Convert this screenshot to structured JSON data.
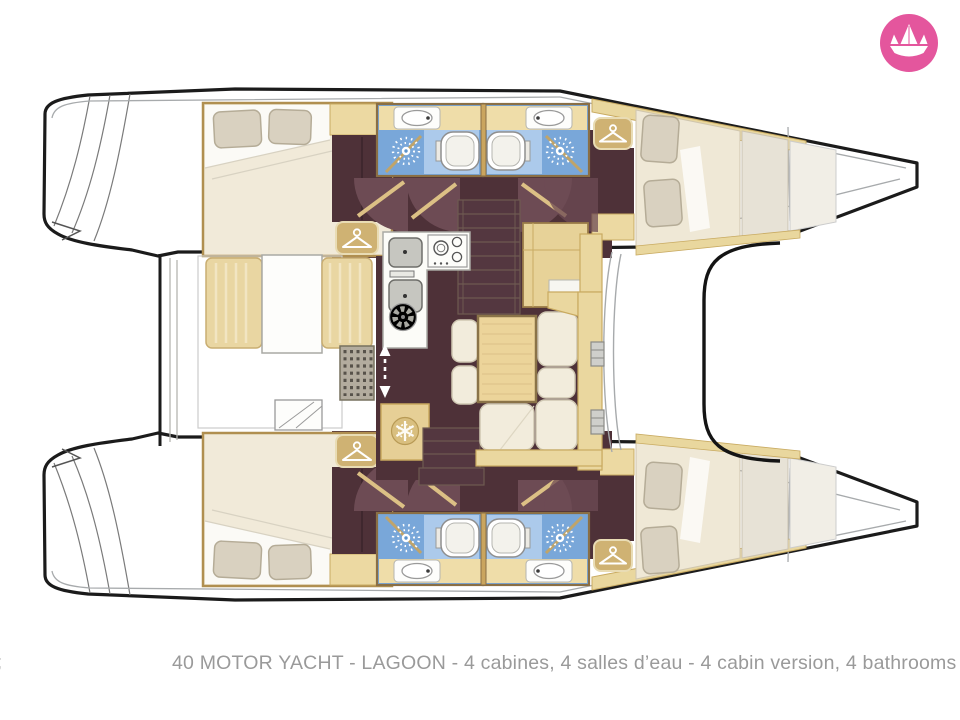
{
  "page": {
    "background_color": "#ffffff",
    "kind": "catamaran yacht deck floor plan"
  },
  "branding": {
    "logo_icon": "paper-boat-icon",
    "logo_bg_color": "#e4569d",
    "logo_fg_color": "#ffffff"
  },
  "caption": {
    "text": "40 MOTOR YACHT - LAGOON - 4 cabines, 4 salles d’eau - 4 cabin version, 4 bathrooms",
    "left_edge_fragment": ";",
    "text_color": "#9a9a9a"
  },
  "floorplan": {
    "vessel_type": "catamaran",
    "cabins_count": 4,
    "bathrooms_count": 4,
    "features": [
      "double-bed-cabin-port-aft",
      "double-bed-cabin-port-forward",
      "double-bed-cabin-starboard-aft",
      "double-bed-cabin-starboard-forward",
      "bathroom-port-aft",
      "bathroom-port-forward",
      "bathroom-starboard-aft",
      "bathroom-starboard-forward",
      "galley-with-sinks-and-stove",
      "salon-table-with-sofa",
      "cockpit-bench",
      "companionway-stairs-forward",
      "companionway-stairs-aft",
      "fridge",
      "wardrobes",
      "bow-deck",
      "stern-platforms"
    ],
    "icons": [
      "hanger-icon",
      "shower-icon",
      "snowflake-icon",
      "fan-icon",
      "up-down-arrow-icon",
      "toilet",
      "sink",
      "stove-burners",
      "door-swing-arc",
      "deck-grate",
      "stairs"
    ],
    "colors": {
      "hull_outline": "#1b1b1b",
      "floor_dark": "#4e3138",
      "door_sweep": "#6d4b54",
      "wood_tan": "#ebd7a0",
      "wood_trim": "#b08f50",
      "bed_cream": "#efe8d6",
      "pillow": "#d9d1c0",
      "bathroom_blue": "#79a7d9",
      "bathroom_blue_light": "#accaeb",
      "fixture_white": "#ffffff"
    }
  }
}
